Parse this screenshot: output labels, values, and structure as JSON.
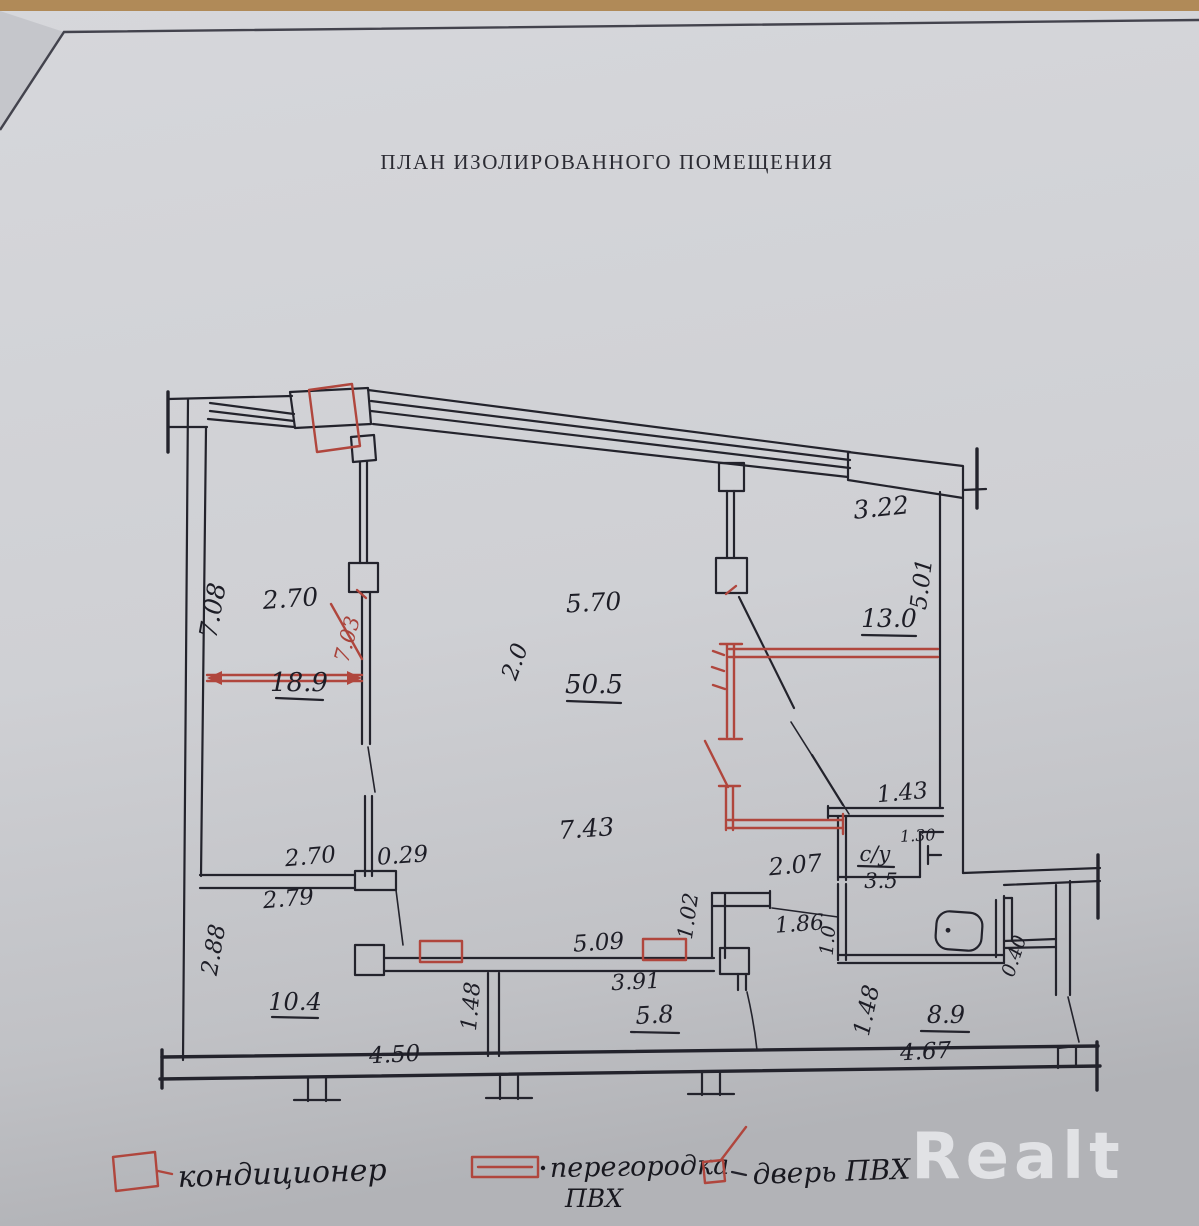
{
  "title": "ПЛАН ИЗОЛИРОВАННОГО ПОМЕЩЕНИЯ",
  "watermark": "Realt",
  "colors": {
    "red_ink": "#b0463d",
    "black_ink": "#23232c",
    "paper": "#d2d3d7"
  },
  "labels": {
    "h_708": "7.08",
    "w_270_top": "2.70",
    "len_703_red": "7.03",
    "area_189": "18.9",
    "w_570": "5.70",
    "w_20": "2.0",
    "area_505": "50.5",
    "w_322": "3.22",
    "h_501": "5.01",
    "area_130": "13.0",
    "w_743": "7.43",
    "w_143": "1.43",
    "su": "с/у",
    "su_area": "3.5",
    "w_130": "1.30",
    "w_207": "2.07",
    "w_186": "1.86",
    "h_10": "1.0",
    "h_102": "1.02",
    "w_509": "5.09",
    "w_270_bottom": "2.70",
    "w_029": "0.29",
    "w_279": "2.79",
    "h_288": "2.88",
    "area_104": "10.4",
    "w_391": "3.91",
    "h_148_left": "1.48",
    "area_58": "5.8",
    "h_148_right": "1.48",
    "area_89": "8.9",
    "h_040": "0.40",
    "w_450": "4.50",
    "w_467": "4.67"
  },
  "legend": {
    "ac": "кондиционер",
    "partition_line1": "перегородка",
    "partition_line2": "ПВХ",
    "door": "дверь ПВХ"
  }
}
